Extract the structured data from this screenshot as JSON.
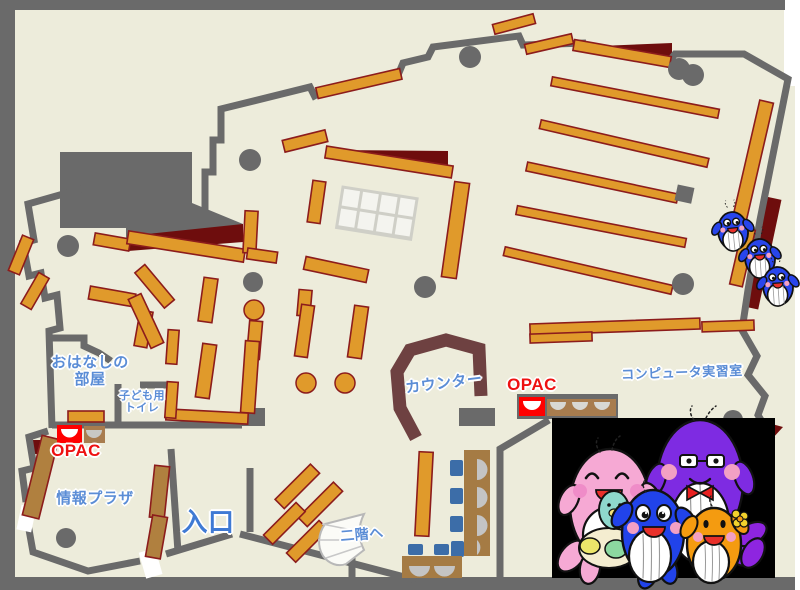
{
  "areas": {
    "storytelling_room": {
      "label_line1": "おはなしの",
      "label_line2": "部屋"
    },
    "kids_toilet": {
      "label_line1": "子ども用",
      "label_line2": "トイレ"
    },
    "info_plaza": {
      "label": "情報プラザ"
    },
    "entrance": {
      "label": "入口"
    },
    "stairs_to_2f": {
      "label": "二階へ"
    },
    "counter": {
      "label": "カウンター"
    },
    "computer_room": {
      "label": "コンピュータ実習室"
    },
    "opac_terminal_left": {
      "label": "OPAC"
    },
    "opac_terminal_right": {
      "label": "OPAC"
    }
  },
  "colors": {
    "floor": "#edecdb",
    "wall_gray": "#6a6a6a",
    "shelf_orange": "#e09a2b",
    "shelf_outline_dark_red": "#8c1c1c",
    "shelf_brown": "#b0803f",
    "accent_dark_red": "#6e0d0d",
    "counter_brown": "#6e4141",
    "opac_red": "#ff0000",
    "chair_blue": "#3c6da8",
    "seat_gray": "#c4c4c4",
    "label_blue": "#5b8dd6",
    "label_entrance_blue": "#3f7ad4",
    "label_red": "#ee1111",
    "mascot_panel": "#000000"
  },
  "mascots": {
    "family_panel": [
      "pink-whale-with-baby",
      "purple-whale-with-glasses",
      "blue-whale",
      "orange-whale-with-flower"
    ],
    "small_blue_whales_on_shelf": 3
  }
}
